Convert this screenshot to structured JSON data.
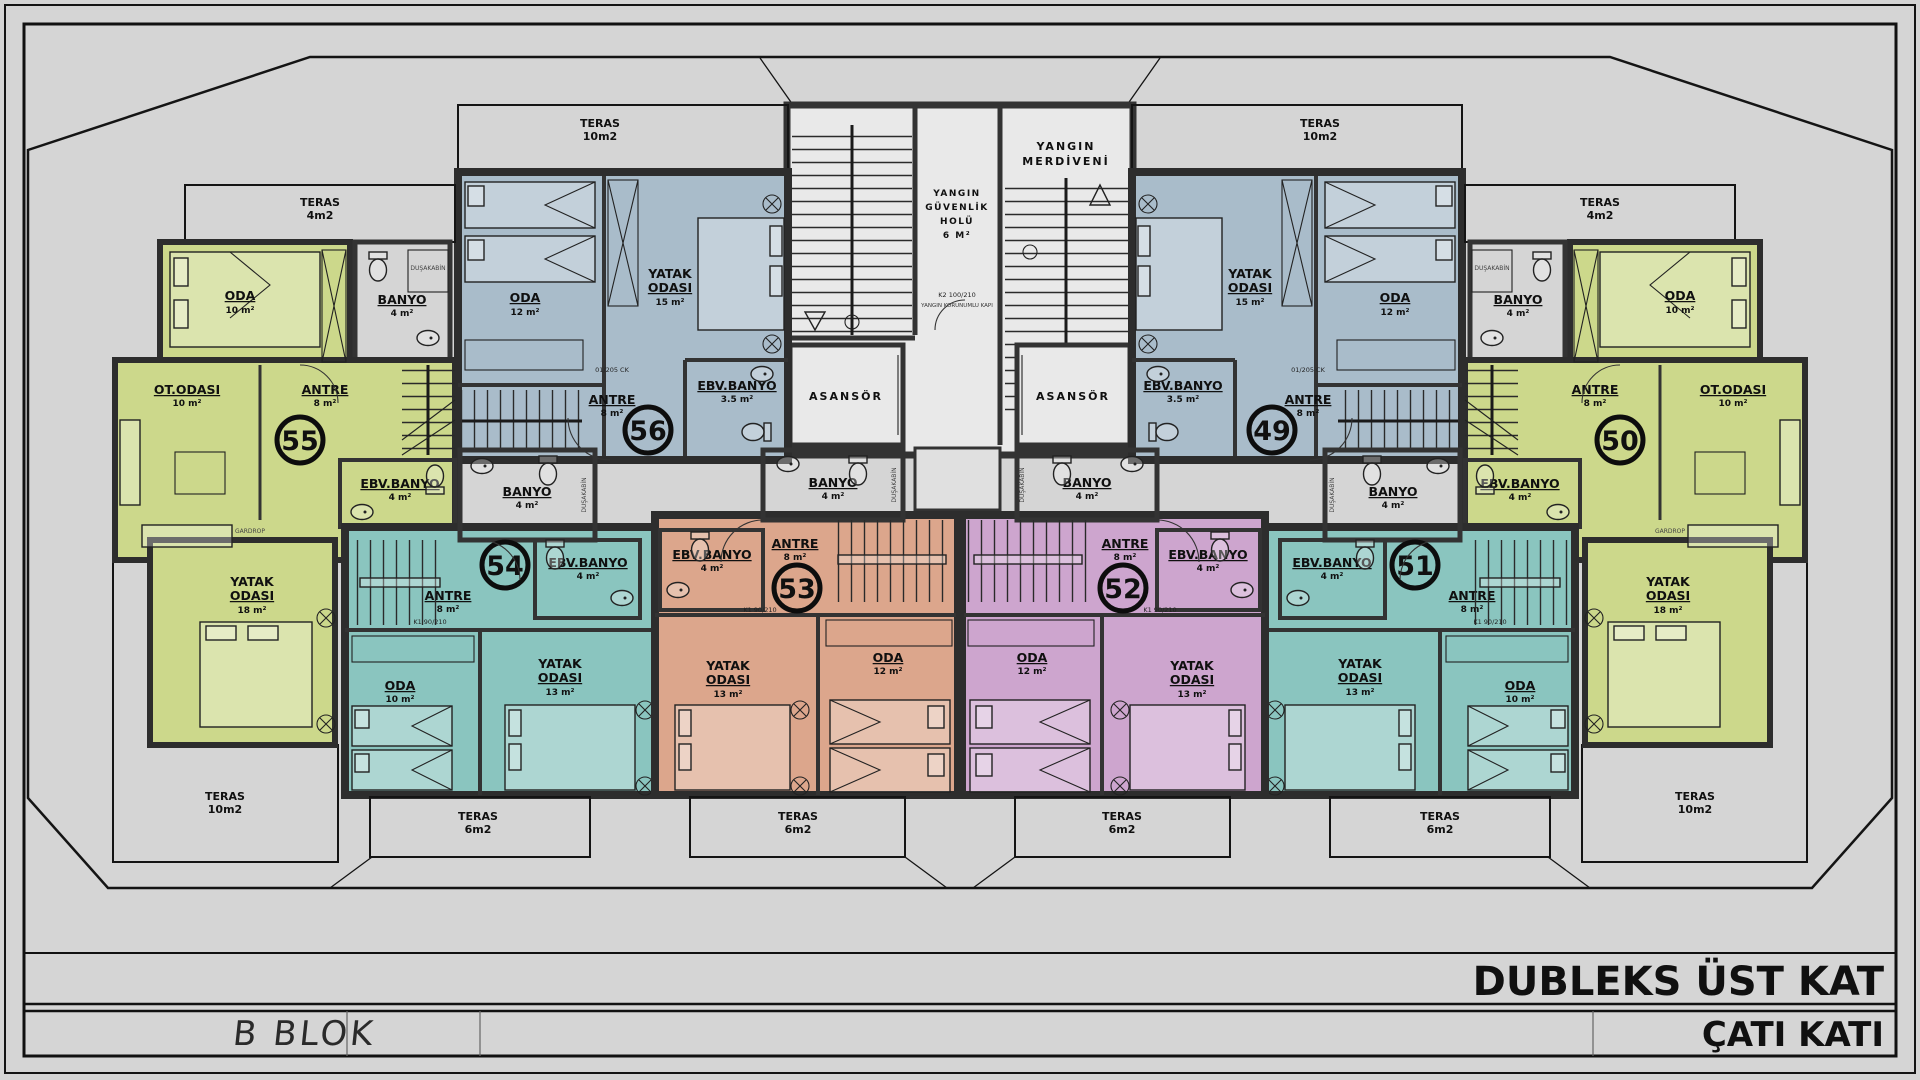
{
  "frame": {
    "title": "DUBLEKS ÜST KAT",
    "subtitle": "ÇATI KATI",
    "block_label": "B BLOK"
  },
  "colors": {
    "background": "#d5d5d5",
    "roof": "#d892a6",
    "roof_line": "#b87390",
    "apt_green": "#ccd88b",
    "apt_blue": "#a9bcca",
    "apt_teal": "#8ac5bf",
    "apt_orange": "#dca68c",
    "apt_purple": "#cda5ce",
    "core_floor": "#e9e9e9",
    "wall": "#2d2d2d"
  },
  "core": {
    "fire_stairs_l1": "YANGIN",
    "fire_stairs_l2": "MERDİVENİ",
    "hall_l1": "YANGIN",
    "hall_l2": "GÜVENLİK",
    "hall_l3": "HOLÜ",
    "hall_l4": "6 M²",
    "elevator": "ASANSÖR",
    "fire_door": "K2 100/210",
    "fire_door_note": "YANGIN KORUNUMLU KAPI"
  },
  "labels": {
    "shower": "DUŞAKABİN",
    "wardrobe": "GARDROP",
    "door_k1": "K1 90/210",
    "door_k2": "K2 90/210",
    "door_d": "01/205 CK"
  },
  "apartments": {
    "a55": {
      "no": "55",
      "teras_top": {
        "n": "TERAS",
        "a": "4m2"
      },
      "oda": {
        "n": "ODA",
        "a": "10 m²"
      },
      "banyo": {
        "n": "BANYO",
        "a": "4 m²"
      },
      "ot_odasi": {
        "n": "OT.ODASI",
        "a": "10 m²"
      },
      "antre": {
        "n": "ANTRE",
        "a": "8 m²"
      },
      "ebv": {
        "n": "EBV.BANYO",
        "a": "4 m²"
      },
      "yatak": {
        "n1": "YATAK",
        "n2": "ODASI",
        "a": "18 m²"
      },
      "teras": {
        "n": "TERAS",
        "a": "10m2"
      }
    },
    "a56": {
      "no": "56",
      "teras": {
        "n": "TERAS",
        "a": "10m2"
      },
      "oda": {
        "n": "ODA",
        "a": "12 m²"
      },
      "yatak": {
        "n1": "YATAK",
        "n2": "ODASI",
        "a": "15 m²"
      },
      "antre": {
        "n": "ANTRE",
        "a": "8 m²"
      },
      "ebv": {
        "n": "EBV.BANYO",
        "a": "3.5 m²"
      }
    },
    "a49": {
      "no": "49",
      "teras": {
        "n": "TERAS",
        "a": "10m2"
      },
      "oda": {
        "n": "ODA",
        "a": "12 m²"
      },
      "yatak": {
        "n1": "YATAK",
        "n2": "ODASI",
        "a": "15 m²"
      },
      "antre": {
        "n": "ANTRE",
        "a": "8 m²"
      },
      "ebv": {
        "n": "EBV.BANYO",
        "a": "3.5 m²"
      }
    },
    "a50": {
      "no": "50",
      "teras_top": {
        "n": "TERAS",
        "a": "4m2"
      },
      "oda": {
        "n": "ODA",
        "a": "10 m²"
      },
      "banyo": {
        "n": "BANYO",
        "a": "4 m²"
      },
      "ot_odasi": {
        "n": "OT.ODASI",
        "a": "10 m²"
      },
      "antre": {
        "n": "ANTRE",
        "a": "8 m²"
      },
      "ebv": {
        "n": "EBV.BANYO",
        "a": "4 m²"
      },
      "yatak": {
        "n1": "YATAK",
        "n2": "ODASI",
        "a": "18 m²"
      },
      "teras": {
        "n": "TERAS",
        "a": "10m2"
      }
    },
    "a54": {
      "no": "54",
      "banyo": {
        "n": "BANYO",
        "a": "4 m²"
      },
      "ebv": {
        "n": "EBV.BANYO",
        "a": "4 m²"
      },
      "antre": {
        "n": "ANTRE",
        "a": "8 m²"
      },
      "yatak": {
        "n1": "YATAK",
        "n2": "ODASI",
        "a": "13 m²"
      },
      "oda": {
        "n": "ODA",
        "a": "10 m²"
      },
      "teras": {
        "n": "TERAS",
        "a": "6m2"
      }
    },
    "a53": {
      "no": "53",
      "banyo": {
        "n": "BANYO",
        "a": "4 m²"
      },
      "ebv": {
        "n": "EBV.BANYO",
        "a": "4 m²"
      },
      "antre": {
        "n": "ANTRE",
        "a": "8 m²"
      },
      "yatak": {
        "n1": "YATAK",
        "n2": "ODASI",
        "a": "13 m²"
      },
      "oda": {
        "n": "ODA",
        "a": "12 m²"
      },
      "teras": {
        "n": "TERAS",
        "a": "6m2"
      }
    },
    "a52": {
      "no": "52",
      "banyo": {
        "n": "BANYO",
        "a": "4 m²"
      },
      "ebv": {
        "n": "EBV.BANYO",
        "a": "4 m²"
      },
      "antre": {
        "n": "ANTRE",
        "a": "8 m²"
      },
      "yatak": {
        "n1": "YATAK",
        "n2": "ODASI",
        "a": "13 m²"
      },
      "oda": {
        "n": "ODA",
        "a": "12 m²"
      },
      "teras": {
        "n": "TERAS",
        "a": "6m2"
      }
    },
    "a51": {
      "no": "51",
      "banyo": {
        "n": "BANYO",
        "a": "4 m²"
      },
      "ebv": {
        "n": "EBV.BANYO",
        "a": "4 m²"
      },
      "antre": {
        "n": "ANTRE",
        "a": "8 m²"
      },
      "yatak": {
        "n1": "YATAK",
        "n2": "ODASI",
        "a": "13 m²"
      },
      "oda": {
        "n": "ODA",
        "a": "10 m²"
      },
      "teras": {
        "n": "TERAS",
        "a": "6m2"
      }
    }
  }
}
